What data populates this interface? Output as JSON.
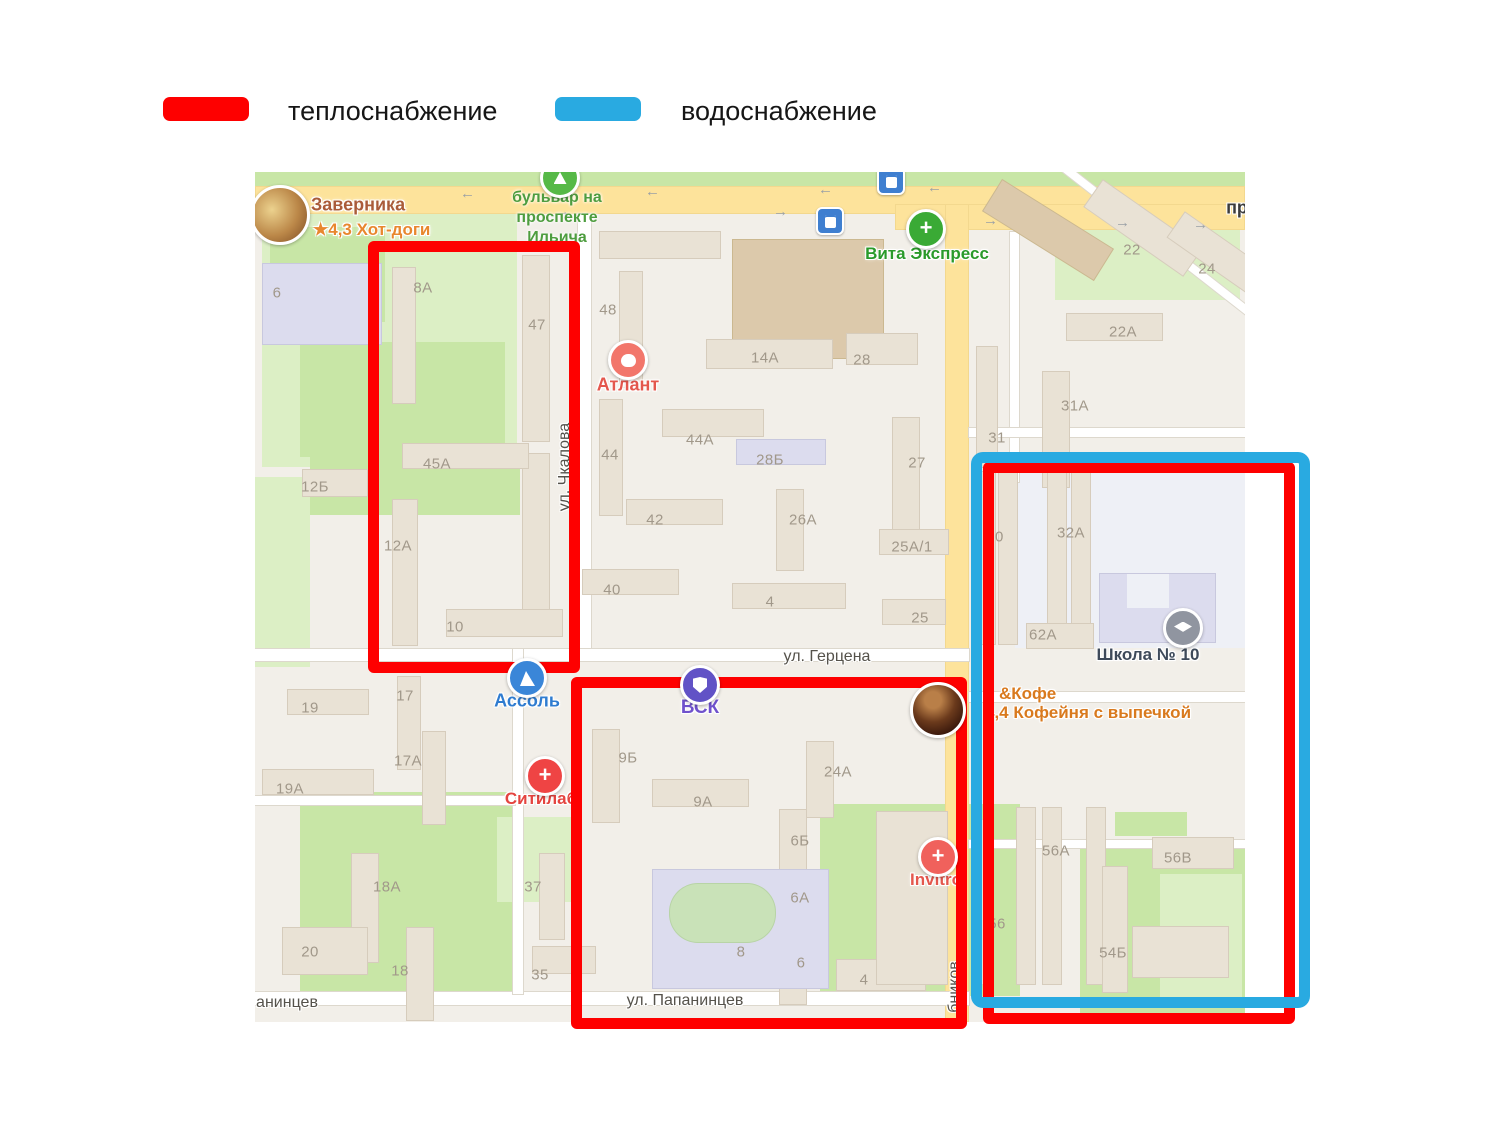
{
  "legend": {
    "items": [
      {
        "id": "heat",
        "label": "теплоснабжение",
        "color": "#fe0000"
      },
      {
        "id": "water",
        "label": "водоснабжение",
        "color": "#29aae1"
      }
    ]
  },
  "map": {
    "boulevard_label": "бульвар на\nпроспекте\nИльича",
    "street_labels": [
      {
        "text": "ул. Герцена",
        "x": 572,
        "y": 485
      },
      {
        "text": "ул. Папанинцев",
        "x": 430,
        "y": 829
      },
      {
        "text": "анинцев",
        "x": 32,
        "y": 831
      },
      {
        "text": "ул. Чкалова",
        "x": 310,
        "y": 295,
        "rot": true
      },
      {
        "text": "бников",
        "x": 700,
        "y": 815,
        "rot": true
      },
      {
        "text": "пр",
        "x": 982,
        "y": 36,
        "bold": true
      }
    ],
    "building_labels": [
      {
        "t": "6",
        "x": 22,
        "y": 121
      },
      {
        "t": "8А",
        "x": 168,
        "y": 116
      },
      {
        "t": "47",
        "x": 282,
        "y": 153
      },
      {
        "t": "12Б",
        "x": 60,
        "y": 315
      },
      {
        "t": "45А",
        "x": 182,
        "y": 292
      },
      {
        "t": "12А",
        "x": 143,
        "y": 374
      },
      {
        "t": "10",
        "x": 200,
        "y": 455
      },
      {
        "t": "17",
        "x": 150,
        "y": 524
      },
      {
        "t": "19",
        "x": 55,
        "y": 536
      },
      {
        "t": "17А",
        "x": 153,
        "y": 589
      },
      {
        "t": "19А",
        "x": 35,
        "y": 617
      },
      {
        "t": "18А",
        "x": 132,
        "y": 715
      },
      {
        "t": "20",
        "x": 55,
        "y": 780
      },
      {
        "t": "18",
        "x": 145,
        "y": 799
      },
      {
        "t": "37",
        "x": 278,
        "y": 715
      },
      {
        "t": "35",
        "x": 285,
        "y": 803
      },
      {
        "t": "48",
        "x": 353,
        "y": 138
      },
      {
        "t": "14А",
        "x": 510,
        "y": 186
      },
      {
        "t": "28",
        "x": 607,
        "y": 188
      },
      {
        "t": "44",
        "x": 355,
        "y": 283
      },
      {
        "t": "44А",
        "x": 445,
        "y": 268
      },
      {
        "t": "28Б",
        "x": 515,
        "y": 288
      },
      {
        "t": "42",
        "x": 400,
        "y": 348
      },
      {
        "t": "26А",
        "x": 548,
        "y": 348
      },
      {
        "t": "27",
        "x": 662,
        "y": 291
      },
      {
        "t": "25А/1",
        "x": 657,
        "y": 375
      },
      {
        "t": "40",
        "x": 357,
        "y": 418
      },
      {
        "t": "4",
        "x": 515,
        "y": 430
      },
      {
        "t": "25",
        "x": 665,
        "y": 446
      },
      {
        "t": "9Б",
        "x": 373,
        "y": 586
      },
      {
        "t": "9А",
        "x": 448,
        "y": 630
      },
      {
        "t": "24А",
        "x": 583,
        "y": 600
      },
      {
        "t": "6Б",
        "x": 545,
        "y": 669
      },
      {
        "t": "6А",
        "x": 545,
        "y": 726
      },
      {
        "t": "6",
        "x": 546,
        "y": 791
      },
      {
        "t": "8",
        "x": 486,
        "y": 780
      },
      {
        "t": "4",
        "x": 609,
        "y": 808
      },
      {
        "t": "22",
        "x": 877,
        "y": 78
      },
      {
        "t": "24",
        "x": 952,
        "y": 97
      },
      {
        "t": "22А",
        "x": 868,
        "y": 160
      },
      {
        "t": "31А",
        "x": 820,
        "y": 234
      },
      {
        "t": "31",
        "x": 742,
        "y": 266
      },
      {
        "t": "30",
        "x": 740,
        "y": 365
      },
      {
        "t": "32А",
        "x": 816,
        "y": 361
      },
      {
        "t": "62А",
        "x": 788,
        "y": 463
      },
      {
        "t": "56А",
        "x": 801,
        "y": 679
      },
      {
        "t": "56В",
        "x": 923,
        "y": 686
      },
      {
        "t": "56",
        "x": 742,
        "y": 752
      },
      {
        "t": "54Б",
        "x": 858,
        "y": 781
      }
    ],
    "pois": [
      {
        "id": "zavernika",
        "icon": "photo-food",
        "size": 54,
        "x": 25,
        "y": 43,
        "lines": [
          {
            "text": "Заверника",
            "x": 56,
            "y": 33,
            "color": "#aa5c39",
            "size": 18
          },
          {
            "text": "★4,3 Хот-доги",
            "x": 58,
            "y": 58,
            "color": "#e8872e",
            "size": 17
          }
        ]
      },
      {
        "id": "atlant",
        "icon": "tooth",
        "color": "#f2766b",
        "x": 373,
        "y": 188,
        "label": {
          "text": "Атлант",
          "x": 373,
          "y": 213,
          "color": "#e4574d",
          "size": 18
        }
      },
      {
        "id": "vita-express",
        "icon": "plus",
        "color": "#3aaa35",
        "x": 671,
        "y": 57,
        "label": {
          "text": "Вита Экспресс",
          "x": 672,
          "y": 82,
          "color": "#2a9a2a",
          "size": 17
        }
      },
      {
        "id": "assol",
        "icon": "sail",
        "color": "#3a86d8",
        "x": 272,
        "y": 506,
        "label": {
          "text": "Ассоль",
          "x": 272,
          "y": 529,
          "color": "#2f7cd0",
          "size": 18
        }
      },
      {
        "id": "citilab",
        "icon": "plus",
        "color": "#ef4444",
        "x": 290,
        "y": 604,
        "label": {
          "text": "Ситилаб",
          "x": 286,
          "y": 627,
          "color": "#e4443f",
          "size": 17
        }
      },
      {
        "id": "vsk",
        "icon": "shield",
        "color": "#6152c6",
        "x": 445,
        "y": 513,
        "label": {
          "text": "ВСК",
          "x": 445,
          "y": 536,
          "color": "#7052cc",
          "size": 19
        }
      },
      {
        "id": "invitro",
        "icon": "plus",
        "color": "#f0615c",
        "x": 683,
        "y": 685,
        "label": {
          "text": "Invitro",
          "x": 681,
          "y": 708,
          "color": "#e4574d",
          "size": 17
        }
      },
      {
        "id": "school-10",
        "icon": "cap",
        "color": "#9095a0",
        "x": 928,
        "y": 456,
        "label": {
          "text": "Школа № 10",
          "x": 893,
          "y": 483,
          "color": "#3e4a5a",
          "size": 17
        }
      },
      {
        "id": "coffee-bakery",
        "icon": "photo-coffee",
        "size": 50,
        "x": 683,
        "y": 538,
        "lines": [
          {
            "text": "&Кофе",
            "x": 744,
            "y": 522,
            "color": "#d97a1e",
            "size": 17
          },
          {
            "text": "4,4 Кофейня с выпечкой",
            "x": 730,
            "y": 541,
            "color": "#d97a1e",
            "size": 17
          }
        ]
      },
      {
        "id": "park-marker",
        "icon": "tree",
        "color": "#56b947",
        "x": 305,
        "y": 6
      },
      {
        "id": "tram-stop-1",
        "icon": "tram",
        "x": 636,
        "y": 9
      },
      {
        "id": "tram-stop-2",
        "icon": "tram",
        "x": 575,
        "y": 49
      }
    ]
  },
  "overlays": [
    {
      "name": "annotation-box-heat-1",
      "legend": "теплоснабжение",
      "color": "#fe0000",
      "x": 368,
      "y": 241,
      "w": 212,
      "h": 432,
      "bw": 11,
      "radius": 6,
      "z": 5
    },
    {
      "name": "annotation-box-heat-2",
      "legend": "теплоснабжение",
      "color": "#fe0000",
      "x": 571,
      "y": 677,
      "w": 396,
      "h": 352,
      "bw": 11,
      "radius": 6,
      "z": 5
    },
    {
      "name": "annotation-box-heat-3",
      "legend": "теплоснабжение",
      "color": "#fe0000",
      "x": 983,
      "y": 462,
      "w": 312,
      "h": 562,
      "bw": 11,
      "radius": 6,
      "z": 5
    },
    {
      "name": "annotation-box-water",
      "legend": "водоснабжение",
      "color": "#29aae1",
      "x": 971,
      "y": 452,
      "w": 339,
      "h": 556,
      "bw": 11,
      "radius": 12,
      "z": 6
    }
  ]
}
